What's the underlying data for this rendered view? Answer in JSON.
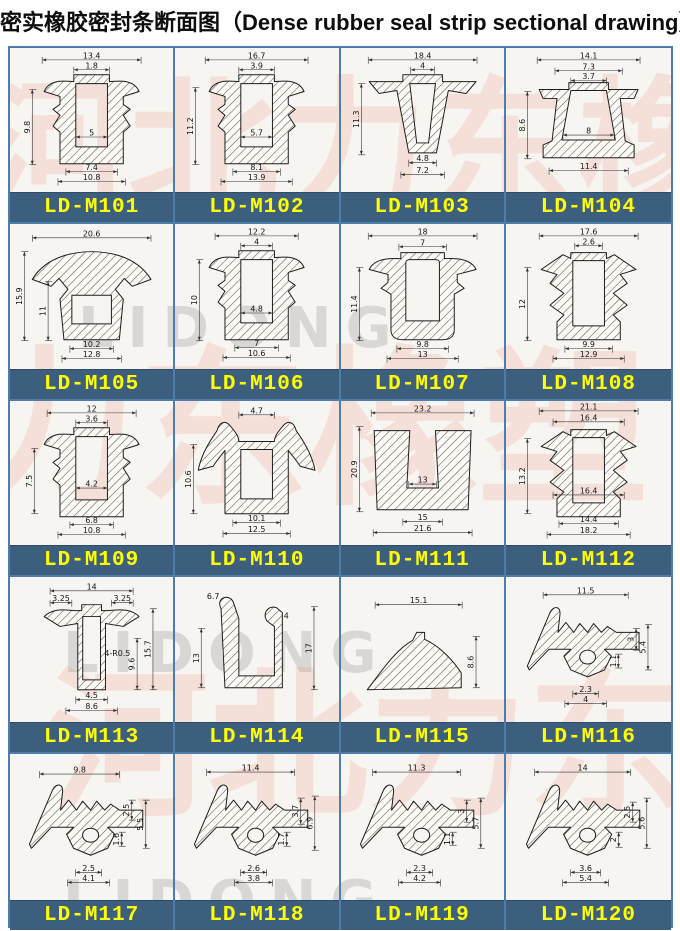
{
  "title": {
    "zh": "密实橡胶密封条断面图",
    "en": "（Dense rubber seal strip sectional drawing）"
  },
  "colors": {
    "label_bg": "#3c5f7e",
    "label_text": "#ffff00",
    "border": "#4d7dad",
    "sheet_bg": "#f6f5f1"
  },
  "watermarks": [
    {
      "text": "河北力东橡塑",
      "x": -30,
      "y": 30,
      "size": 150,
      "cls": "wm-red"
    },
    {
      "text": "力东橡塑",
      "x": -40,
      "y": 300,
      "size": 170,
      "cls": "wm-red"
    },
    {
      "text": "河北力东",
      "x": 40,
      "y": 620,
      "size": 160,
      "cls": "wm-red"
    },
    {
      "text": "LIDONG",
      "x": 70,
      "y": 255,
      "size": 56,
      "cls": "wm-gray"
    },
    {
      "text": "LIDONG",
      "x": 55,
      "y": 580,
      "size": 56,
      "cls": "wm-gray"
    },
    {
      "text": "LIDONG",
      "x": 55,
      "y": 828,
      "size": 56,
      "cls": "wm-gray"
    }
  ],
  "cells": [
    {
      "label": "LD-M101",
      "profile": "M32,44 C38,30 56,34 62,34 L62,27 L98,27 L98,34 C104,34 122,30 128,44 L112,49 L112,57 L119,62 L112,68 L119,79 L112,85 L112,117 L48,117 L48,85 L41,79 L48,68 L41,62 L48,57 L48,49 Z M64,36 L96,36 L96,100 L64,100 Z",
      "dims": [
        [
          "13.4",
          "h",
          30,
          12,
          100
        ],
        [
          "1.8",
          "h",
          62,
          22,
          36
        ],
        [
          "9.8",
          "v",
          20,
          42,
          76
        ],
        [
          "5",
          "h",
          64,
          90,
          32
        ],
        [
          "7.4",
          "h",
          54,
          125,
          52
        ],
        [
          "10.8",
          "h",
          46,
          135,
          68
        ]
      ]
    },
    {
      "label": "LD-M102",
      "profile": "M32,44 C38,30 56,34 62,34 L62,27 L98,27 L98,34 C104,34 122,30 128,44 L112,49 L112,57 L119,62 L112,68 L119,79 L112,85 L112,117 L48,117 L48,85 L41,79 L48,68 L41,62 L48,57 L48,49 Z M64,36 L96,36 L96,100 L64,100 Z",
      "dims": [
        [
          "16.7",
          "h",
          28,
          12,
          104
        ],
        [
          "3.9",
          "h",
          62,
          22,
          36
        ],
        [
          "11.2",
          "v",
          18,
          40,
          78
        ],
        [
          "5.7",
          "h",
          64,
          90,
          32
        ],
        [
          "8.1",
          "h",
          56,
          125,
          48
        ],
        [
          "13.9",
          "h",
          44,
          135,
          72
        ]
      ]
    },
    {
      "label": "LD-M103",
      "profile": "M26,34 L60,34 L60,27 L100,27 L100,34 L134,34 L124,46 L106,43 L94,106 L66,106 L54,43 L36,46 Z M67,36 L93,36 L86,96 L74,96 Z",
      "dims": [
        [
          "18.4",
          "h",
          25,
          12,
          110
        ],
        [
          "4",
          "h",
          68,
          22,
          24
        ],
        [
          "11.3",
          "v",
          18,
          36,
          72
        ],
        [
          "4.8",
          "h",
          66,
          116,
          28
        ],
        [
          "7.2",
          "h",
          58,
          128,
          44
        ]
      ]
    },
    {
      "label": "LD-M104",
      "profile": "M30,42 L60,42 L60,35 L100,35 L100,42 L130,42 L126,51 L112,51 L117,94 L126,98 L126,111 L34,111 L34,98 L43,94 L48,51 L34,51 Z M62,43 L98,43 L107,93 L53,93 Z",
      "dims": [
        [
          "14.1",
          "h",
          28,
          12,
          104
        ],
        [
          "7.3",
          "h",
          46,
          23,
          68
        ],
        [
          "3.7",
          "h",
          62,
          33,
          36
        ],
        [
          "8.6",
          "v",
          18,
          44,
          68
        ],
        [
          "8",
          "h",
          54,
          88,
          52
        ],
        [
          "11.4",
          "h",
          40,
          124,
          80
        ]
      ]
    },
    {
      "label": "LD-M105",
      "profile": "M20,56 C36,30 68,28 80,28 C92,28 124,30 140,56 L121,63 L113,55 L104,66 L112,76 L108,117 L52,117 L48,76 L56,66 L47,55 L39,63 Z M60,72 L100,72 L100,101 L60,101 Z",
      "dims": [
        [
          "20.6",
          "h",
          20,
          14,
          120
        ],
        [
          "15.9",
          "v",
          12,
          28,
          90
        ],
        [
          "11",
          "v",
          36,
          58,
          60
        ],
        [
          "10.2",
          "h",
          58,
          126,
          44
        ],
        [
          "12.8",
          "h",
          50,
          136,
          60
        ]
      ]
    },
    {
      "label": "LD-M106",
      "profile": "M32,44 C38,30 56,34 62,34 L62,27 L98,27 L98,34 C104,34 122,30 128,44 L112,49 L112,57 L119,62 L112,68 L119,79 L112,85 L112,117 L48,117 L48,85 L41,79 L48,68 L41,62 L48,57 L48,49 Z M64,36 L96,36 L96,100 L64,100 Z",
      "dims": [
        [
          "12.2",
          "h",
          38,
          12,
          84
        ],
        [
          "4",
          "h",
          64,
          22,
          32
        ],
        [
          "10",
          "v",
          22,
          36,
          82
        ],
        [
          "4.8",
          "h",
          64,
          90,
          32
        ],
        [
          "7",
          "h",
          58,
          125,
          44
        ],
        [
          "10.6",
          "h",
          46,
          135,
          68
        ]
      ]
    },
    {
      "label": "LD-M107",
      "profile": "M26,46 C32,33 52,35 58,35 L58,29 L102,29 L102,35 C108,35 128,33 134,46 L115,51 L115,59 L122,65 L112,71 L112,107 C112,114 107,117 100,117 L60,117 C53,117 48,114 48,107 L48,71 L38,65 L45,59 L45,51 Z M63,39 C63,37 65,36 67,36 L93,36 C95,36 97,37 97,39 L97,98 L63,98 Z",
      "dims": [
        [
          "18",
          "h",
          25,
          12,
          110
        ],
        [
          "7",
          "h",
          56,
          23,
          48
        ],
        [
          "11.4",
          "v",
          16,
          44,
          74
        ],
        [
          "9.8",
          "h",
          54,
          126,
          52
        ],
        [
          "13",
          "h",
          44,
          136,
          72
        ]
      ]
    },
    {
      "label": "LD-M108",
      "profile": "M32,46 L54,31 L62,35 L62,29 L98,29 L98,35 L106,31 L128,46 L112,51 L119,60 L105,70 L119,82 L105,92 L112,99 L112,117 L48,117 L48,99 L55,92 L41,82 L55,70 L41,60 L48,51 Z M64,37 L96,37 L96,103 L64,103 Z",
      "dims": [
        [
          "17.6",
          "h",
          30,
          12,
          100
        ],
        [
          "2.6",
          "h",
          66,
          22,
          28
        ],
        [
          "12",
          "v",
          18,
          44,
          74
        ],
        [
          "9.9",
          "h",
          56,
          126,
          48
        ],
        [
          "12.9",
          "h",
          44,
          136,
          72
        ]
      ]
    },
    {
      "label": "LD-M109",
      "profile": "M32,44 C38,30 56,34 62,34 L62,27 L98,27 L98,34 C104,34 122,30 128,44 L112,49 L112,57 L119,62 L112,68 L119,79 L112,85 L112,117 L48,117 L48,85 L41,79 L48,68 L41,62 L48,57 L48,49 Z M64,36 L96,36 L96,100 L64,100 Z",
      "dims": [
        [
          "12",
          "h",
          35,
          12,
          90
        ],
        [
          "3.6",
          "h",
          64,
          22,
          32
        ],
        [
          "7.5",
          "v",
          22,
          48,
          66
        ],
        [
          "4.2",
          "h",
          64,
          88,
          32
        ],
        [
          "6.8",
          "h",
          58,
          125,
          44
        ],
        [
          "10.8",
          "h",
          46,
          135,
          68
        ]
      ]
    },
    {
      "label": "LD-M110",
      "profile": "M54,26 C48,18 42,22 40,30 C30,44 23,58 21,70 L36,66 C41,58 45,54 48,50 L48,114 L112,114 L112,50 C115,54 119,58 124,66 L139,70 C137,58 130,44 120,30 C118,22 112,18 106,26 C101,32 98,36 98,41 L62,41 C62,36 59,32 54,26 Z M64,49 L96,49 L96,99 L64,99 Z",
      "dims": [
        [
          "4.7",
          "h",
          62,
          14,
          36
        ],
        [
          "10.6",
          "v",
          16,
          44,
          70
        ],
        [
          "10.1",
          "h",
          56,
          123,
          48
        ],
        [
          "12.5",
          "h",
          46,
          134,
          68
        ]
      ]
    },
    {
      "label": "LD-M111",
      "profile": "M31,30 L67,30 L64,88 L96,88 L93,30 L129,30 L126,110 L34,110 Z",
      "dims": [
        [
          "23.2",
          "h",
          28,
          12,
          104
        ],
        [
          "20.9",
          "v",
          16,
          26,
          86
        ],
        [
          "13",
          "h",
          66,
          84,
          28
        ],
        [
          "15",
          "h",
          60,
          122,
          40
        ],
        [
          "21.6",
          "h",
          30,
          133,
          100
        ]
      ]
    },
    {
      "label": "LD-M112",
      "profile": "M32,46 L54,31 L62,35 L62,29 L98,29 L98,35 L106,31 L128,46 L112,51 L119,60 L105,70 L119,82 L105,92 L112,99 L112,117 L48,117 L48,99 L55,92 L41,82 L55,70 L41,60 L48,51 Z M64,37 L96,37 L96,103 L64,103 Z",
      "dims": [
        [
          "21.1",
          "h",
          30,
          10,
          100
        ],
        [
          "16.4",
          "h",
          44,
          21,
          72
        ],
        [
          "13.2",
          "v",
          18,
          38,
          76
        ],
        [
          "16.4",
          "h",
          44,
          95,
          72
        ],
        [
          "14.4",
          "h",
          50,
          124,
          60
        ],
        [
          "18.2",
          "h",
          38,
          135,
          84
        ]
      ]
    },
    {
      "label": "LD-M113",
      "profile": "M32,40 C42,30 56,34 64,34 L70,34 L70,28 L90,28 L90,34 L96,34 C104,34 118,30 128,40 L112,50 L94,47 L94,114 L66,114 L66,47 L48,50 Z M71,40 L89,40 L89,104 L71,104 Z",
      "dims": [
        [
          "14",
          "h",
          38,
          14,
          84
        ],
        [
          "3.25",
          "h",
          38,
          26,
          22
        ],
        [
          "3.25",
          "h",
          100,
          26,
          22
        ],
        [
          "4-R0.5",
          "t",
          106,
          80,
          0
        ],
        [
          "15.7",
          "v",
          142,
          32,
          82
        ],
        [
          "9.6",
          "v",
          126,
          62,
          52
        ],
        [
          "4.5",
          "h",
          64,
          124,
          32
        ],
        [
          "8.6",
          "h",
          54,
          135,
          52
        ]
      ]
    },
    {
      "label": "LD-M114",
      "profile": "M44,32 C38,20 54,16 57,27 L62,42 L62,100 L98,100 L98,50 L91,45 C85,38 91,28 100,31 L106,36 L106,112 L48,112 Z",
      "dims": [
        [
          "6.7",
          "t",
          36,
          22,
          0
        ],
        [
          "4",
          "t",
          110,
          42,
          0
        ],
        [
          "13",
          "v",
          24,
          52,
          60
        ],
        [
          "17",
          "v",
          138,
          30,
          84
        ]
      ]
    },
    {
      "label": "LD-M115",
      "profile": "M24,114 C38,96 52,74 70,64 L74,56 L82,56 L82,63 C98,70 112,86 119,97 L119,112 Z",
      "dims": [
        [
          "15.1",
          "h",
          32,
          28,
          88
        ],
        [
          "8.6",
          "v",
          134,
          60,
          52
        ]
      ]
    },
    {
      "label": "LD-M116",
      "profile": "M41,36 C45,28 52,30 51,38 L49,56 L57,46 L65,56 L71,47 L79,56 L85,47 L93,56 L99,50 L108,56 L131,56 L131,73 L96,73 L103,80 L96,94 L79,101 L62,94 L55,80 L62,73 L40,73 L20,94 L18,90 Z M71,81 a8,7 0 1,0 16,0 a8,7 0 1,0 -16,0 Z",
      "dims": [
        [
          "11.5",
          "h",
          34,
          18,
          86
        ],
        [
          "3",
          "v",
          128,
          52,
          22
        ],
        [
          "5.4",
          "v",
          140,
          48,
          46
        ],
        [
          "1.1",
          "v",
          110,
          78,
          14
        ],
        [
          "2.3",
          "h",
          64,
          118,
          26
        ],
        [
          "4",
          "h",
          56,
          128,
          42
        ]
      ]
    },
    {
      "label": "LD-M117",
      "profile": "M41,36 C45,28 52,30 51,38 L49,56 L57,46 L65,56 L71,47 L79,56 L85,47 L93,56 L99,50 L108,56 L131,56 L131,73 L96,73 L103,80 L96,94 L79,101 L62,94 L55,80 L62,73 L40,73 L20,94 L18,90 Z M71,81 a8,7 0 1,0 16,0 a8,7 0 1,0 -16,0 Z",
      "dims": [
        [
          "9.8",
          "h",
          28,
          20,
          80
        ],
        [
          "2.5",
          "v",
          120,
          46,
          20
        ],
        [
          "5.5",
          "v",
          134,
          46,
          48
        ],
        [
          "1.6",
          "v",
          110,
          78,
          14
        ],
        [
          "2.5",
          "h",
          64,
          118,
          26
        ],
        [
          "4.1",
          "h",
          56,
          128,
          42
        ]
      ]
    },
    {
      "label": "LD-M118",
      "profile": "M41,36 C45,28 52,30 51,38 L49,56 L57,46 L65,56 L71,47 L79,56 L85,47 L93,56 L99,50 L108,56 L131,56 L131,73 L96,73 L103,80 L96,94 L79,101 L62,94 L55,80 L62,73 L40,73 L20,94 L18,90 Z M71,81 a8,7 0 1,0 16,0 a8,7 0 1,0 -16,0 Z",
      "dims": [
        [
          "11.4",
          "h",
          30,
          18,
          88
        ],
        [
          "3.7",
          "v",
          124,
          44,
          26
        ],
        [
          "6.9",
          "v",
          138,
          42,
          54
        ],
        [
          "1.7",
          "v",
          110,
          78,
          14
        ],
        [
          "2.6",
          "h",
          64,
          118,
          26
        ],
        [
          "3.8",
          "h",
          58,
          128,
          38
        ]
      ]
    },
    {
      "label": "LD-M119",
      "profile": "M41,36 C45,28 52,30 51,38 L49,56 L57,46 L65,56 L71,47 L79,56 L85,47 L93,56 L99,50 L108,56 L131,56 L131,73 L96,73 L103,80 L96,94 L79,101 L62,94 L55,80 L62,73 L40,73 L20,94 L18,90 Z M71,81 a8,7 0 1,0 16,0 a8,7 0 1,0 -16,0 Z",
      "dims": [
        [
          "11.3",
          "h",
          30,
          18,
          88
        ],
        [
          "3",
          "v",
          124,
          46,
          22
        ],
        [
          "5.7",
          "v",
          138,
          44,
          50
        ],
        [
          "1.1",
          "v",
          110,
          78,
          13
        ],
        [
          "2.3",
          "h",
          64,
          118,
          26
        ],
        [
          "4.2",
          "h",
          56,
          128,
          42
        ]
      ]
    },
    {
      "label": "LD-M120",
      "profile": "M41,36 C45,28 52,30 51,38 L49,56 L57,46 L65,56 L71,47 L79,56 L85,47 L93,56 L99,50 L108,56 L131,56 L131,73 L96,73 L103,80 L96,94 L79,101 L62,94 L55,80 L62,73 L40,73 L20,94 L18,90 Z M71,81 a8,7 0 1,0 16,0 a8,7 0 1,0 -16,0 Z",
      "dims": [
        [
          "14",
          "h",
          26,
          18,
          96
        ],
        [
          "2.5",
          "v",
          124,
          48,
          20
        ],
        [
          "5.6",
          "v",
          138,
          44,
          50
        ],
        [
          "2",
          "v",
          110,
          78,
          15
        ],
        [
          "3.6",
          "h",
          62,
          118,
          30
        ],
        [
          "5.4",
          "h",
          54,
          128,
          46
        ]
      ]
    }
  ]
}
